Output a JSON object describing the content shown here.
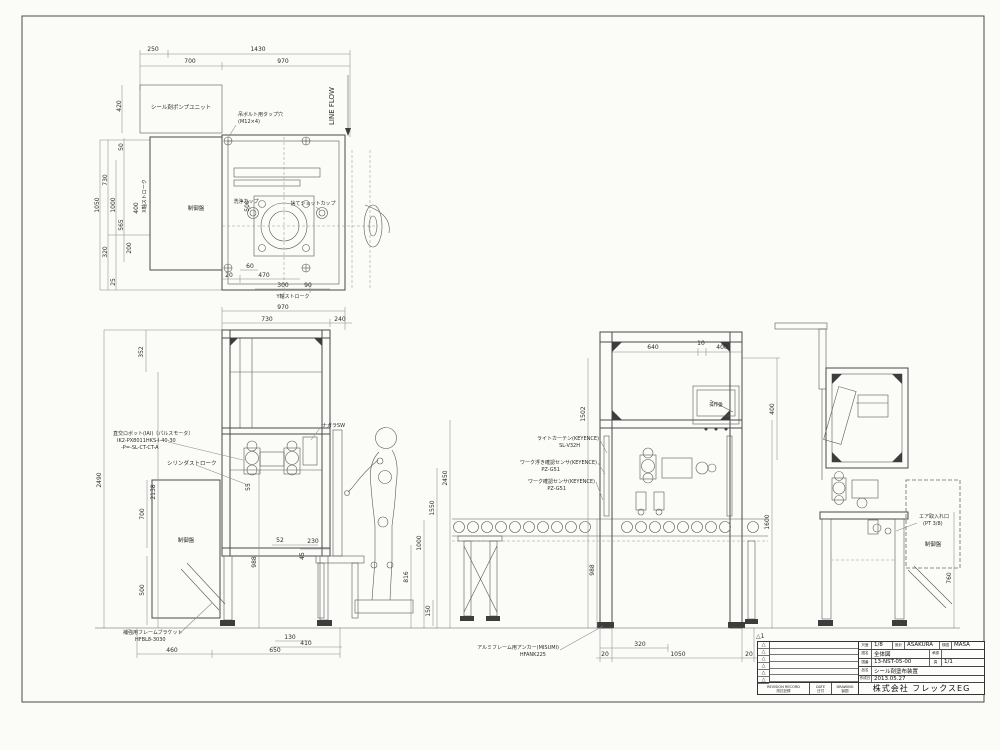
{
  "paper": {
    "revision_tag": "△1"
  },
  "top": {
    "dims": [
      "250",
      "1430",
      "700",
      "970",
      "1050",
      "730",
      "320",
      "1000",
      "25",
      "50",
      "565",
      "200",
      "400",
      "420",
      "500",
      "20",
      "470",
      "60",
      "300",
      "90"
    ],
    "labels": {
      "pump_unit": "シール剤ポンプユニット",
      "control_panel": "制御盤",
      "wash_cup": "洗浄カップ",
      "waste_shot_cup": "捨てショットカップ",
      "eyebolt_line1": "吊ボルト用タップ穴",
      "eyebolt_line2": "(M12×4)",
      "line_flow": "LINE FLOW",
      "x_stroke": "X軸ストローク",
      "y_stroke": "Y軸ストローク"
    }
  },
  "front": {
    "dims": [
      "970",
      "730",
      "240",
      "352",
      "2490",
      "2138",
      "700",
      "500",
      "988",
      "55",
      "52",
      "230",
      "45",
      "460",
      "650",
      "130",
      "410",
      "2450",
      "1550",
      "1000",
      "816",
      "150"
    ],
    "labels": {
      "control_panel": "制御盤",
      "robot_line1": "直交ロボット(IAI)〔パルスモータ〕",
      "robot_line2": "IK2-PX8011HKS-I-40-30",
      "robot_line3": "-P=-SL-CT-CT-A",
      "cylinder_stroke": "シリンダストローク",
      "nagara_sw": "ナガラSW",
      "bracket_line1": "補強用フレームブラケット",
      "bracket_line2": "HFBL8-3030"
    }
  },
  "station": {
    "dims": [
      "640",
      "10",
      "400",
      "400",
      "1502",
      "988",
      "1600",
      "320",
      "1050",
      "20",
      "20"
    ],
    "labels": {
      "light_curtain_line1": "ライトカーテン(KEYENCE)",
      "light_curtain_line2": "SL-V32H",
      "float_sensor_line1": "ワーク浮き確認センサ(KEYENCE)",
      "float_sensor_line2": "PZ-G51",
      "work_sensor_line1": "ワーク確認センサ(KEYENCE)",
      "work_sensor_line2": "PZ-G51",
      "operation_panel": "操作盤",
      "anchor_line1": "アルミフレーム用アンカー(MISUMI)",
      "anchor_line2": "HFANK225"
    }
  },
  "side": {
    "dims": [
      "760"
    ],
    "labels": {
      "air_inlet_line1": "エア取入れ口",
      "air_inlet_line2": "(PT 3/8)",
      "control_panel": "制御盤"
    }
  },
  "title_block": {
    "scale_label": "尺度",
    "scale": "1/8",
    "designed_label": "設計",
    "designed": "ASAKURA",
    "checked_label": "検図",
    "checked": "MASA",
    "approved_label": "承認",
    "name_label": "図名",
    "name": "全体図",
    "dwg_no_label": "図番",
    "dwg_no": "13-NST-05-00",
    "sheet_label": "頁",
    "sheet": "1/1",
    "product_label": "品名",
    "product": "シール剤塗布装置",
    "date_label": "作成日",
    "date": "2013.05.27",
    "company": "株式会社 フレックスEG",
    "rev_record_en": "REVISION RECORD",
    "rev_record_jp": "改訂記録",
    "date_col_en": "DATE",
    "date_col_jp": "日付",
    "drawing_col_en": "DRAWING",
    "drawing_col_jp": "製図",
    "rev_marks": [
      "△",
      "△",
      "△",
      "△",
      "△",
      "△"
    ]
  }
}
